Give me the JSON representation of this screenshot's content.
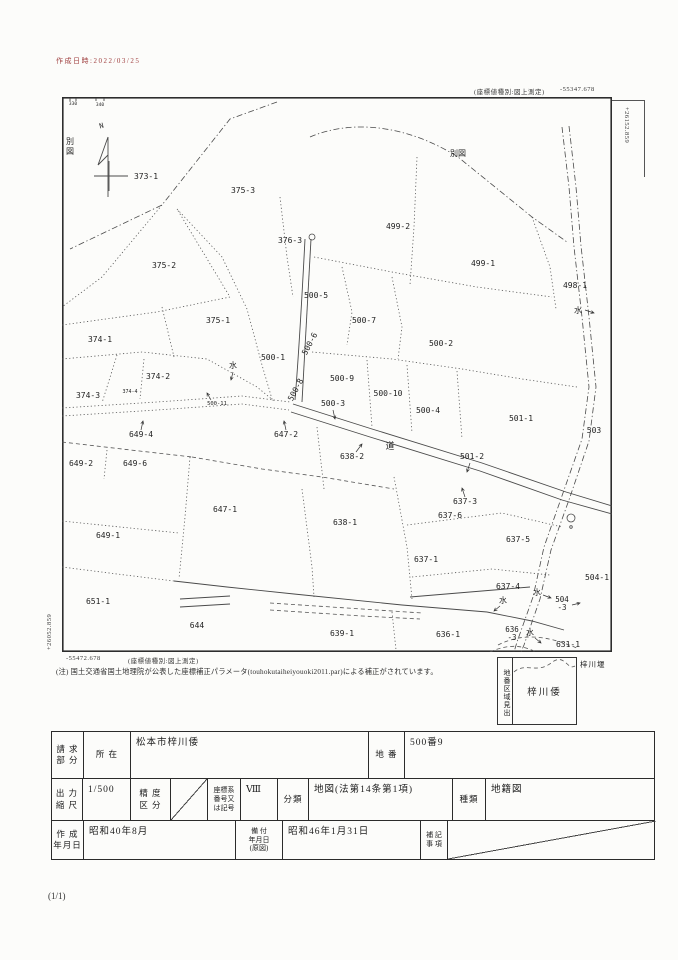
{
  "header": {
    "timestamp": "作成日時:2022/03/25",
    "timestamp_color": "#a04040"
  },
  "coords": {
    "top_note": "(座標値種別:図上測定)",
    "top_value": "-55347.678",
    "right_vertical": "+26152.859",
    "left_vertical": "+26052.859",
    "bottom_value": "-55472.678",
    "bottom_note": "(座標値種別:図上測定)"
  },
  "footnote": "(注) 国土交通省国土地理院が公表した座標補正パラメータ(touhokutaiheiyouoki2011.par)による補正がされています。",
  "legend_box": {
    "side_label": "地番区域見出",
    "area_name": "梓川倭",
    "weir_label": "梓川堰"
  },
  "page": {
    "number": "(1/1)"
  },
  "map": {
    "labels": [
      {
        "t": "330",
        "x": 11,
        "y": 8,
        "size": 4.5,
        "name": "border-tick-label"
      },
      {
        "t": "340",
        "x": 38,
        "y": 9,
        "size": 4.5,
        "name": "border-tick-label"
      },
      {
        "t": "N",
        "x": 40,
        "y": 31,
        "size": 7,
        "rot": -15,
        "name": "north-label"
      },
      {
        "t": "別\n図",
        "x": 8,
        "y": 47,
        "size": 8,
        "serif": true,
        "lh": 10,
        "name": "map-ref-left"
      },
      {
        "t": "373-1",
        "x": 84,
        "y": 82
      },
      {
        "t": "375-3",
        "x": 181,
        "y": 96
      },
      {
        "t": "376-3",
        "x": 228,
        "y": 146
      },
      {
        "t": "別図",
        "x": 396,
        "y": 59,
        "serif": true,
        "name": "map-ref-top"
      },
      {
        "t": "499-2",
        "x": 336,
        "y": 132
      },
      {
        "t": "499-1",
        "x": 421,
        "y": 169
      },
      {
        "t": "498-1",
        "x": 513,
        "y": 191
      },
      {
        "t": "水",
        "x": 516,
        "y": 216,
        "serif": true,
        "leader": [
          523,
          213,
          532,
          216
        ],
        "name": "water-label"
      },
      {
        "t": "500-5",
        "x": 254,
        "y": 201
      },
      {
        "t": "375-2",
        "x": 102,
        "y": 171
      },
      {
        "t": "375-1",
        "x": 156,
        "y": 226
      },
      {
        "t": "374-1",
        "x": 38,
        "y": 245
      },
      {
        "t": "500-7",
        "x": 302,
        "y": 226
      },
      {
        "t": "500-6",
        "x": 250,
        "y": 248,
        "rot": -62
      },
      {
        "t": "500-1",
        "x": 211,
        "y": 263
      },
      {
        "t": "500-2",
        "x": 379,
        "y": 249
      },
      {
        "t": "374-2",
        "x": 96,
        "y": 282
      },
      {
        "t": "水",
        "x": 171,
        "y": 271,
        "serif": true,
        "leader": [
          171,
          275,
          169,
          283
        ],
        "name": "water-label"
      },
      {
        "t": "500-8",
        "x": 236,
        "y": 294,
        "rot": -62
      },
      {
        "t": "500-9",
        "x": 280,
        "y": 284
      },
      {
        "t": "500-10",
        "x": 326,
        "y": 299
      },
      {
        "t": "500-3",
        "x": 271,
        "y": 309,
        "leader": [
          271,
          313,
          273,
          322
        ]
      },
      {
        "t": "500-4",
        "x": 366,
        "y": 316
      },
      {
        "t": "374-3",
        "x": 26,
        "y": 301
      },
      {
        "t": "374-4",
        "x": 68,
        "y": 296,
        "size": 5
      },
      {
        "t": "500-11",
        "x": 155,
        "y": 308,
        "size": 5.5,
        "leader": [
          149,
          303,
          145,
          296
        ]
      },
      {
        "t": "501-1",
        "x": 459,
        "y": 324
      },
      {
        "t": "503",
        "x": 532,
        "y": 336
      },
      {
        "t": "道",
        "x": 328,
        "y": 352,
        "size": 9,
        "serif": true,
        "name": "road-label"
      },
      {
        "t": "501-2",
        "x": 410,
        "y": 362,
        "leader": [
          408,
          366,
          405,
          375
        ]
      },
      {
        "t": "649-4",
        "x": 79,
        "y": 340,
        "leader": [
          79,
          333,
          81,
          324
        ]
      },
      {
        "t": "649-2",
        "x": 19,
        "y": 369
      },
      {
        "t": "649-6",
        "x": 73,
        "y": 369
      },
      {
        "t": "647-2",
        "x": 224,
        "y": 340,
        "leader": [
          224,
          333,
          222,
          324
        ]
      },
      {
        "t": "638-2",
        "x": 290,
        "y": 362,
        "leader": [
          294,
          355,
          300,
          347
        ]
      },
      {
        "t": "647-1",
        "x": 163,
        "y": 415
      },
      {
        "t": "638-1",
        "x": 283,
        "y": 428
      },
      {
        "t": "637-3",
        "x": 403,
        "y": 407,
        "leader": [
          403,
          400,
          400,
          391
        ]
      },
      {
        "t": "637-6",
        "x": 388,
        "y": 421
      },
      {
        "t": "637-5",
        "x": 456,
        "y": 445
      },
      {
        "t": "637-1",
        "x": 364,
        "y": 465
      },
      {
        "t": "504-1",
        "x": 535,
        "y": 483
      },
      {
        "t": "637-4",
        "x": 446,
        "y": 492
      },
      {
        "t": "水",
        "x": 441,
        "y": 506,
        "serif": true,
        "leader": [
          438,
          509,
          432,
          514
        ],
        "name": "water-label"
      },
      {
        "t": "水",
        "x": 475,
        "y": 498,
        "serif": true,
        "leader": [
          481,
          498,
          489,
          501
        ],
        "name": "water-label"
      },
      {
        "t": "504\n-3",
        "x": 500,
        "y": 505,
        "size": 7.5,
        "lh": 8,
        "leader": [
          510,
          508,
          518,
          506
        ]
      },
      {
        "t": "649-1",
        "x": 46,
        "y": 441
      },
      {
        "t": "651-1",
        "x": 36,
        "y": 507
      },
      {
        "t": "644",
        "x": 135,
        "y": 531
      },
      {
        "t": "639-1",
        "x": 280,
        "y": 539
      },
      {
        "t": "636-1",
        "x": 386,
        "y": 540
      },
      {
        "t": "636\n-3",
        "x": 450,
        "y": 535,
        "size": 7.5,
        "lh": 8
      },
      {
        "t": "水",
        "x": 468,
        "y": 538,
        "serif": true,
        "leader": [
          473,
          541,
          479,
          546
        ],
        "name": "water-label"
      },
      {
        "t": "631-1",
        "x": 506,
        "y": 550
      }
    ]
  },
  "table": {
    "row1": {
      "c1a": "請 求",
      "c1b": "部 分",
      "c2": "所  在",
      "c3": "松本市梓川倭",
      "c4": "地  番",
      "c5": "500番9"
    },
    "row2": {
      "c1a": "出 力",
      "c1b": "縮 尺",
      "c2": "1/500",
      "c3a": "精 度",
      "c3b": "区 分",
      "c5a": "座標系",
      "c5b": "番号又",
      "c5c": "は記号",
      "c6": "Ⅷ",
      "c7": "分類",
      "c8": "地図(法第14条第1項)",
      "c9": "種類",
      "c10": "地籍図"
    },
    "row3": {
      "c1a": "作 成",
      "c1b": "年月日",
      "c2": "昭和40年8月",
      "c3a": "備 付",
      "c3b": "年月日",
      "c3c": "(原図)",
      "c4": "昭和46年1月31日",
      "c5a": "補 記",
      "c5b": "事 項"
    }
  }
}
